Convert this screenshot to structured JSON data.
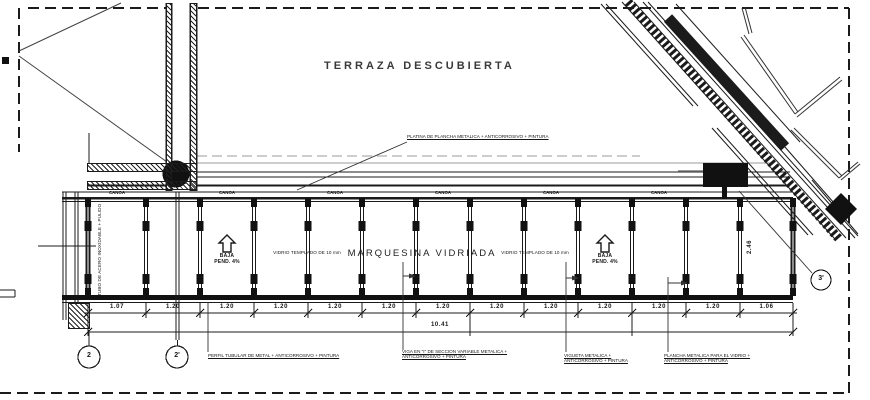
{
  "title": "TERRAZA  DESCUBIERTA",
  "canopy": {
    "label": "MARQUESINA  VIDRIADA",
    "gutter_labels": [
      "CANOA",
      "CANOA",
      "CANOA",
      "CANOA",
      "CANOA",
      "CANOA"
    ],
    "glass_note_left": "VIDRIO TEMPLADO DE 10 mm",
    "glass_note_right": "VIDRIO TEMPLADO DE 10 mm",
    "slope_left": {
      "word": "BAJA",
      "pend": "PEND. 4%"
    },
    "slope_right": {
      "word": "BAJA",
      "pend": "PEND. 4%"
    },
    "post_note": "TUBO DE ACERO INOXIDABLE + PULIDO"
  },
  "notes": {
    "top": "PLATINA DE PLANCHA METALICA + ANTICORROSIVO + PINTURA",
    "bottom": [
      "PERFIL TUBULAR DE METAL + ANTICORROSIVO + PINTURA",
      "VIGA EN \"I\" DE SECCION VARIABLE METALICA + ANTICORROSIVO + PINTURA",
      "VIGUETA METALICA + ANTICORROSIVO + PINTURA",
      "PLANCHA METALICA PARA EL VIDRIO + ANTICORROSIVO + PINTURA"
    ]
  },
  "dimensions": {
    "segments": [
      "1.07",
      "1.20",
      "1.20",
      "1.20",
      "1.20",
      "1.20",
      "1.20",
      "1.20",
      "1.20",
      "1.20",
      "1.20",
      "1.20",
      "1.06"
    ],
    "total": "10.41",
    "height": "2.46"
  },
  "grid_bubbles": [
    {
      "label": "2"
    },
    {
      "label": "2'"
    },
    {
      "label": "3'"
    }
  ],
  "colors": {
    "line": "#1b1b1b",
    "gray": "#9b9b9b",
    "bg": "#ffffff"
  }
}
